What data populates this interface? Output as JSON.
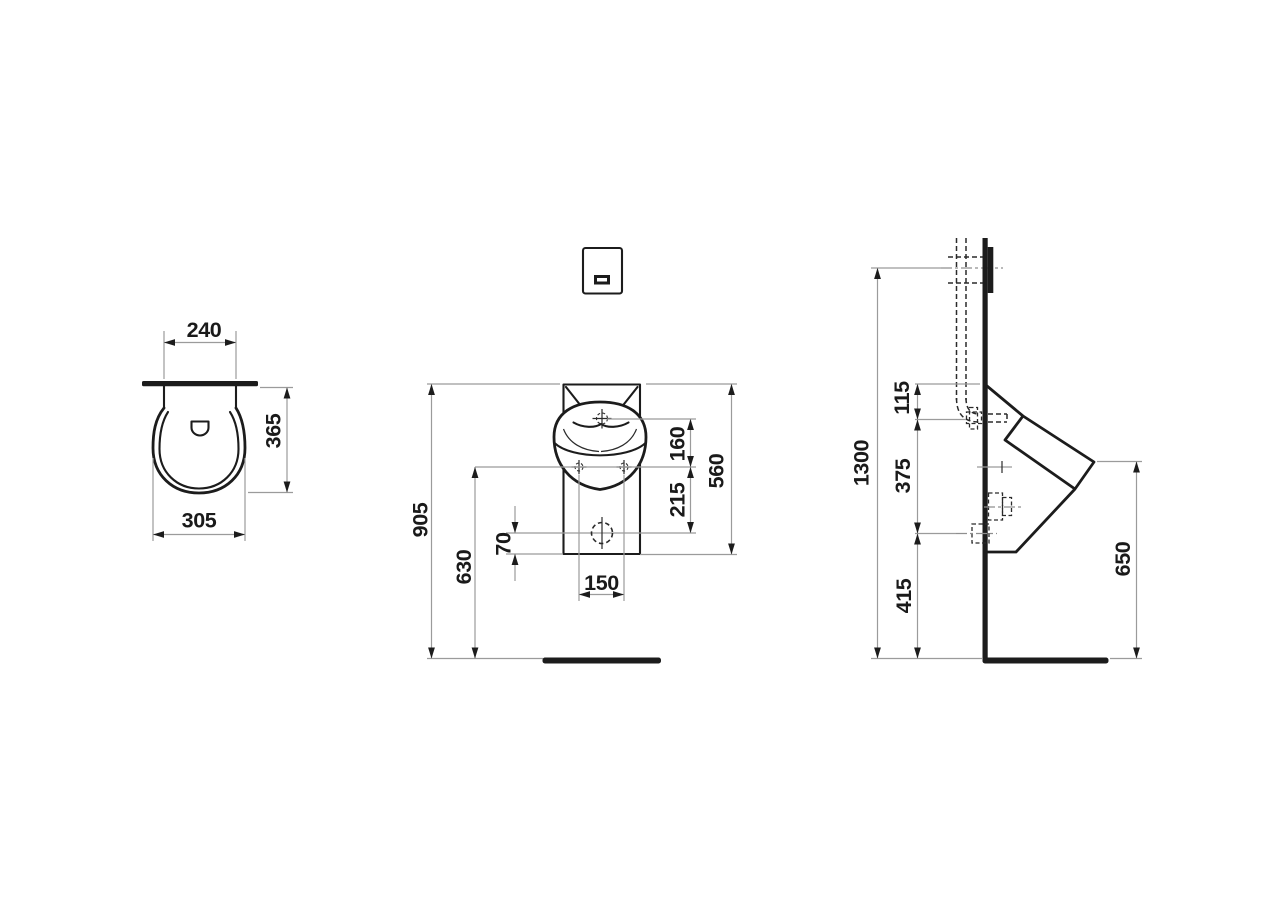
{
  "drawing_title": "Urinal installation dimension drawing",
  "colors": {
    "line": "#1c1c1c",
    "dim_line": "#9b9b9b",
    "background": "#ffffff"
  },
  "views": {
    "top": {
      "label": "top-view",
      "dims": {
        "back_width": "240",
        "depth": "365",
        "width": "305"
      }
    },
    "front": {
      "label": "front-view",
      "dims": {
        "overall_height": "905",
        "fixing_height": "630",
        "drain_offset": "70",
        "hole_spacing": "150",
        "fixing_to_drain": "215",
        "tap_to_fixing": "160",
        "ceramic_height": "560"
      }
    },
    "side": {
      "label": "side-view",
      "dims": {
        "flush_center_height": "1300",
        "top_to_inlet": "115",
        "inlet_to_outlet": "375",
        "outlet_height": "415",
        "front_edge_height": "650"
      }
    }
  }
}
